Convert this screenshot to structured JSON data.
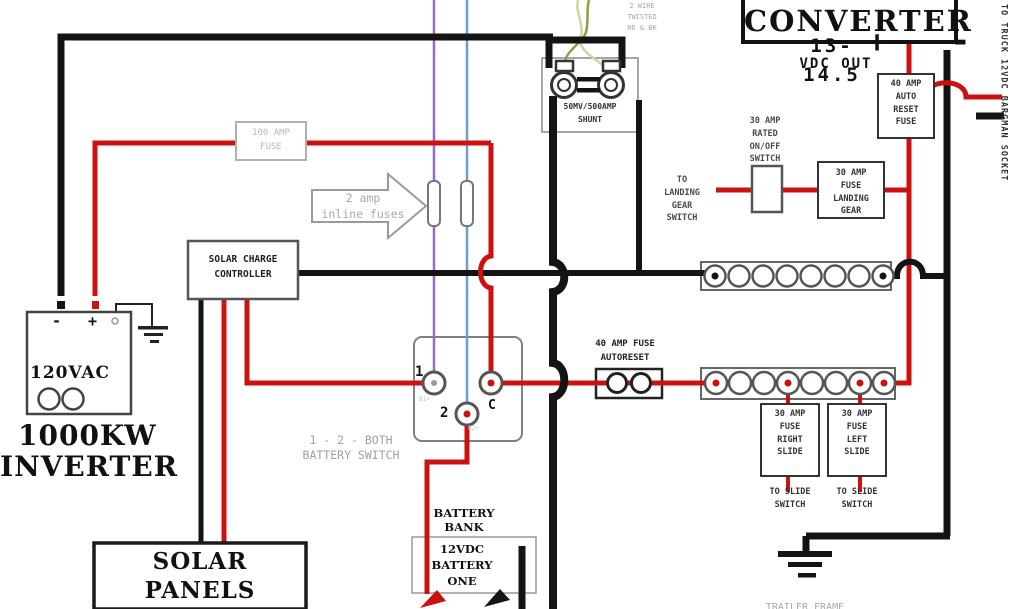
{
  "colors": {
    "wire_red": "#cc1111",
    "wire_black": "#141414",
    "wire_purple": "#8f6fc9",
    "wire_blue": "#6f9ec9",
    "wire_olive": "#9a9a44",
    "wire_pale_green": "#ccd6a0",
    "gray_label": "#a8a8a8"
  },
  "converter": {
    "title": "CONVERTER",
    "output_range": "13-14.5",
    "plus": "+",
    "output_unit": "VDC  OUT",
    "minus": "-"
  },
  "right_side": {
    "auto_reset_fuse": "40 AMP\nAUTO\nRESET\nFUSE",
    "truck_socket": "TO TRUCK 12VDC BARGMAN SOCKET",
    "onoff_switch": "30 AMP\nRATED\nON/OFF\nSWITCH",
    "to_landing_gear": "TO\nLANDING\nGEAR\nSWITCH",
    "landing_gear_fuse": "30 AMP\nFUSE\nLANDING\nGEAR",
    "fuse_right_slide": "30 AMP\nFUSE\nRIGHT\nSLIDE",
    "fuse_left_slide": "30 AMP\nFUSE\nLEFT\nSLIDE",
    "to_slide_switch_1": "TO SLIDE\nSWITCH",
    "to_slide_switch_2": "TO SLIDE\nSWITCH",
    "frame_ground": "TRAILER FRAME"
  },
  "center": {
    "shunt": "50MV/500AMP\nSHUNT",
    "twisted_pair": "2 WIRE\nTWISTED\nRD & BK",
    "autoreset_fuse": "40 AMP FUSE\nAUTORESET",
    "inline_fuses": "2 amp\ninline fuses",
    "main_fuse": "100 AMP\nFUSE",
    "battery_switch_caption": "1 - 2 - BOTH\nBATTERY SWITCH",
    "terminal_1": "1",
    "terminal_2": "2",
    "terminal_c": "C",
    "terminal_1_sub": "B1+",
    "terminal_2_sub": "B2+",
    "solar_charge_controller": "SOLAR CHARGE\nCONTROLLER",
    "battery_bank": "BATTERY\nBANK",
    "battery_one": "12VDC\nBATTERY\nONE"
  },
  "left_side": {
    "inverter_minus": "-",
    "inverter_plus": "+",
    "inverter_voltage": "120VAC",
    "inverter_name_1": "1000KW",
    "inverter_name_2": "INVERTER",
    "solar_panels": "SOLAR\nPANELS"
  }
}
